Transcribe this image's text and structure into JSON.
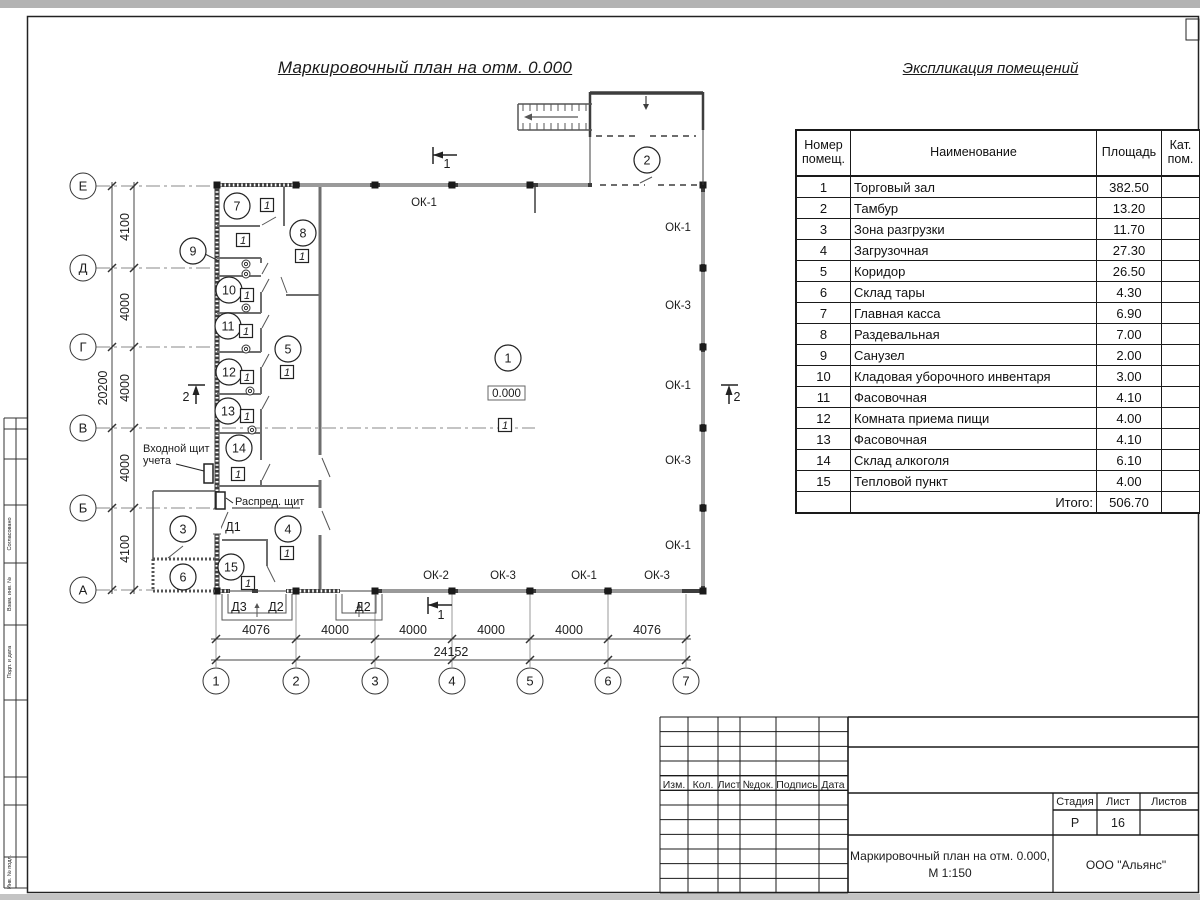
{
  "titles": {
    "plan": "Маркировочный план на отм. 0.000",
    "explication": "Экспликация помещений"
  },
  "explication": {
    "headers": {
      "num": "Номер помещ.",
      "name": "Наименование",
      "area": "Площадь",
      "cat": "Кат. пом."
    },
    "rows": [
      [
        "1",
        "Торговый зал",
        "382.50"
      ],
      [
        "2",
        "Тамбур",
        "13.20"
      ],
      [
        "3",
        "Зона разгрузки",
        "11.70"
      ],
      [
        "4",
        "Загрузочная",
        "27.30"
      ],
      [
        "5",
        "Коридор",
        "26.50"
      ],
      [
        "6",
        "Склад тары",
        "4.30"
      ],
      [
        "7",
        "Главная касса",
        "6.90"
      ],
      [
        "8",
        "Раздевальная",
        "7.00"
      ],
      [
        "9",
        "Санузел",
        "2.00"
      ],
      [
        "10",
        "Кладовая уборочного инвентаря",
        "3.00"
      ],
      [
        "11",
        "Фасовочная",
        "4.10"
      ],
      [
        "12",
        "Комната приема пищи",
        "4.00"
      ],
      [
        "13",
        "Фасовочная",
        "4.10"
      ],
      [
        "14",
        "Склад алкоголя",
        "6.10"
      ],
      [
        "15",
        "Тепловой пункт",
        "4.00"
      ]
    ],
    "total_label": "Итого:",
    "total": "506.70"
  },
  "plan": {
    "elevation": "0.000",
    "floor_mark_label": "1",
    "rooms": [
      {
        "n": "1",
        "x": 508,
        "y": 358
      },
      {
        "n": "2",
        "x": 647,
        "y": 160
      },
      {
        "n": "3",
        "x": 183,
        "y": 529
      },
      {
        "n": "4",
        "x": 288,
        "y": 529
      },
      {
        "n": "5",
        "x": 288,
        "y": 349
      },
      {
        "n": "6",
        "x": 183,
        "y": 577
      },
      {
        "n": "7",
        "x": 237,
        "y": 206
      },
      {
        "n": "8",
        "x": 303,
        "y": 233
      },
      {
        "n": "9",
        "x": 193,
        "y": 251
      },
      {
        "n": "10",
        "x": 229,
        "y": 290
      },
      {
        "n": "11",
        "x": 228,
        "y": 326
      },
      {
        "n": "12",
        "x": 229,
        "y": 372
      },
      {
        "n": "13",
        "x": 228,
        "y": 411
      },
      {
        "n": "14",
        "x": 239,
        "y": 448
      },
      {
        "n": "15",
        "x": 231,
        "y": 567
      }
    ],
    "floor_marks": [
      [
        505,
        425
      ],
      [
        287,
        553
      ],
      [
        287,
        372
      ],
      [
        267,
        205
      ],
      [
        302,
        256
      ],
      [
        243,
        240
      ],
      [
        247,
        295
      ],
      [
        246,
        331
      ],
      [
        247,
        377
      ],
      [
        247,
        416
      ],
      [
        238,
        474
      ],
      [
        248,
        583
      ]
    ],
    "window_labels": [
      {
        "t": "ОК-1",
        "x": 424,
        "y": 206
      },
      {
        "t": "ОК-1",
        "x": 678,
        "y": 231
      },
      {
        "t": "ОК-3",
        "x": 678,
        "y": 309
      },
      {
        "t": "ОК-1",
        "x": 678,
        "y": 389
      },
      {
        "t": "ОК-3",
        "x": 678,
        "y": 464
      },
      {
        "t": "ОК-1",
        "x": 678,
        "y": 549
      },
      {
        "t": "ОК-2",
        "x": 436,
        "y": 579
      },
      {
        "t": "ОК-3",
        "x": 503,
        "y": 579
      },
      {
        "t": "ОК-1",
        "x": 584,
        "y": 579
      },
      {
        "t": "ОК-3",
        "x": 657,
        "y": 579
      }
    ],
    "door_labels": [
      {
        "t": "Д1",
        "x": 233,
        "y": 531
      },
      {
        "t": "Д3",
        "x": 239,
        "y": 611
      },
      {
        "t": "Д2",
        "x": 276,
        "y": 611
      },
      {
        "t": "Д2",
        "x": 363,
        "y": 611
      }
    ],
    "axis_rows": [
      {
        "t": "Е",
        "y": 186
      },
      {
        "t": "Д",
        "y": 268
      },
      {
        "t": "Г",
        "y": 347
      },
      {
        "t": "В",
        "y": 428
      },
      {
        "t": "Б",
        "y": 508
      },
      {
        "t": "А",
        "y": 590
      }
    ],
    "axis_cols": [
      {
        "t": "1",
        "x": 216
      },
      {
        "t": "2",
        "x": 296
      },
      {
        "t": "3",
        "x": 375
      },
      {
        "t": "4",
        "x": 452
      },
      {
        "t": "5",
        "x": 530
      },
      {
        "t": "6",
        "x": 608
      },
      {
        "t": "7",
        "x": 686
      }
    ],
    "dims_left": [
      {
        "t": "4100",
        "y": 227
      },
      {
        "t": "4000",
        "y": 307
      },
      {
        "t": "4000",
        "y": 388
      },
      {
        "t": "4000",
        "y": 468
      },
      {
        "t": "4100",
        "y": 549
      }
    ],
    "dims_left_total": {
      "t": "20200",
      "y": 388
    },
    "dims_bottom": [
      {
        "t": "4076",
        "x": 256
      },
      {
        "t": "4000",
        "x": 335
      },
      {
        "t": "4000",
        "x": 413
      },
      {
        "t": "4000",
        "x": 491
      },
      {
        "t": "4000",
        "x": 569
      },
      {
        "t": "4076",
        "x": 647
      }
    ],
    "dims_bottom_total": {
      "t": "24152",
      "x": 451
    },
    "section_marks": [
      {
        "t": "1",
        "x": 447,
        "y": 168
      },
      {
        "t": "1",
        "x": 441,
        "y": 619
      },
      {
        "t": "2",
        "x": 186,
        "y": 401
      },
      {
        "t": "2",
        "x": 737,
        "y": 401
      }
    ],
    "panel_label_1a": "Входной щит",
    "panel_label_1b": "учета",
    "panel_label_2": "Распред. щит"
  },
  "title_block": {
    "cols": [
      "Изм.",
      "Кол.",
      "Лист",
      "№док.",
      "Подпись",
      "Дата"
    ],
    "stage_label": "Стадия",
    "sheet_label": "Лист",
    "sheets_label": "Листов",
    "stage": "Р",
    "sheet": "16",
    "doc_line1": "Маркировочный план на отм. 0.000,",
    "doc_line2": "М 1:150",
    "company": "ООО \"Альянс\""
  },
  "frame": {
    "side_cells": [
      {
        "t": "Согласовано",
        "y": 534
      },
      {
        "t": "Взам. инв. №",
        "y": 594
      },
      {
        "t": "Подп. и дата",
        "y": 662
      },
      {
        "t": "Инв. № подл.",
        "y": 872
      }
    ]
  }
}
